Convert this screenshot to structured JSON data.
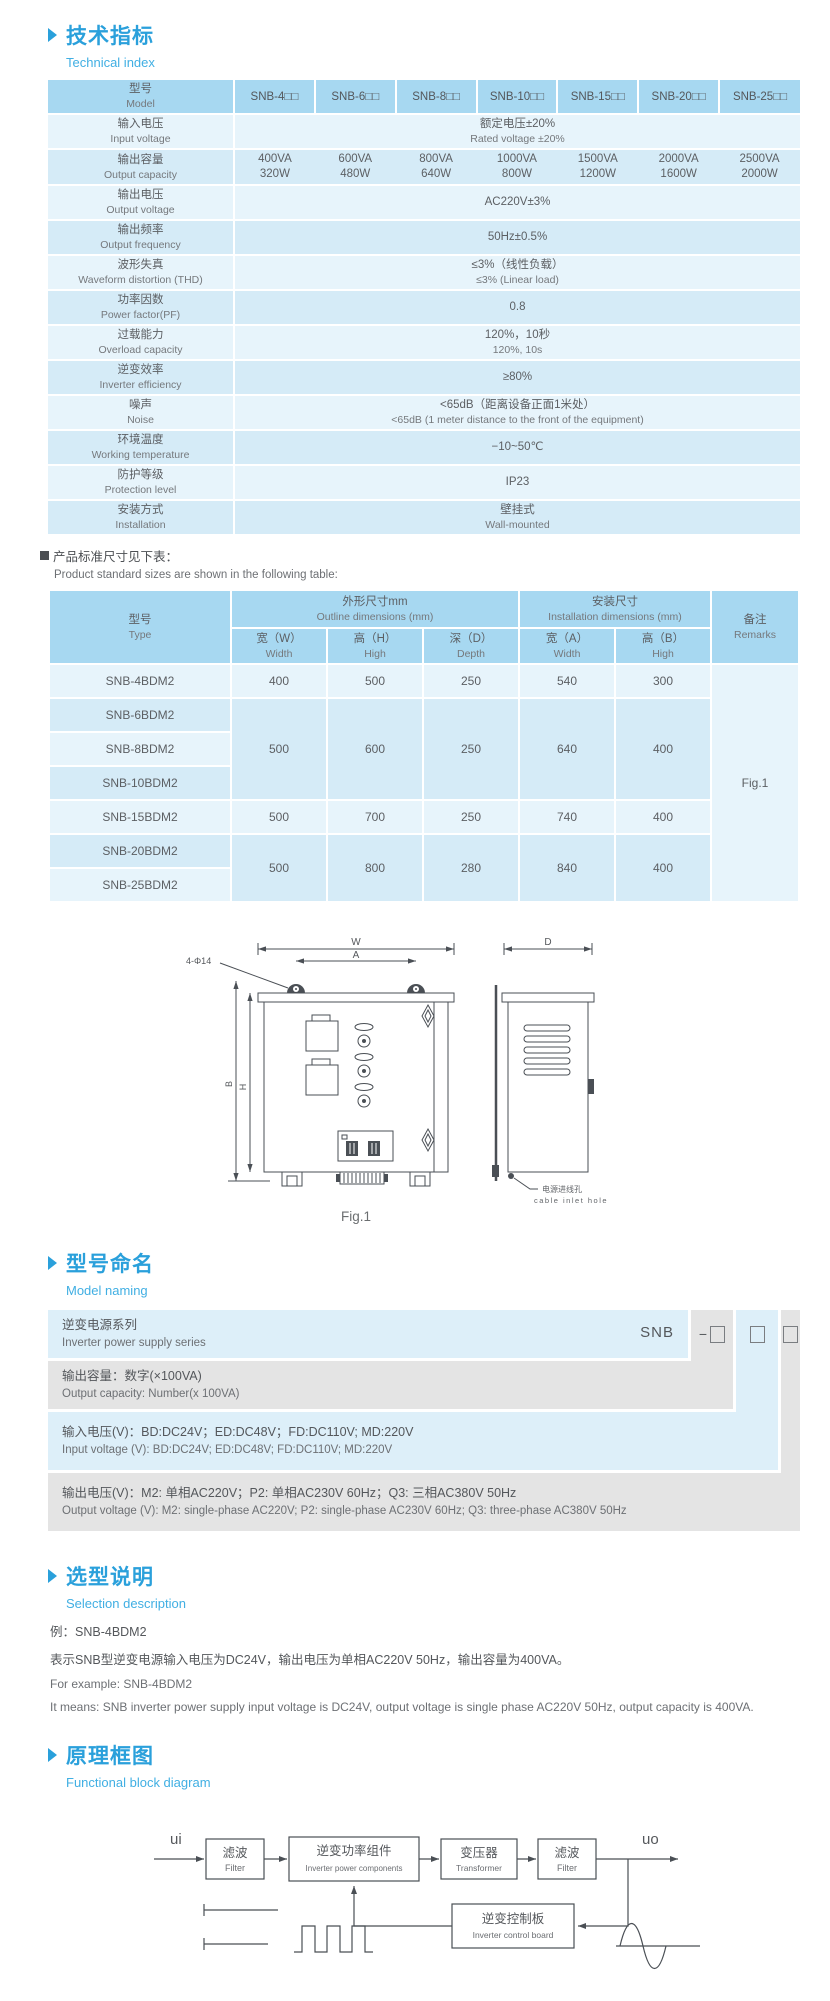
{
  "technical": {
    "title_cn": "技术指标",
    "title_en": "Technical index",
    "spec": {
      "header": {
        "label_cn": "型号",
        "label_en": "Model",
        "models": [
          "SNB-4□□",
          "SNB-6□□",
          "SNB-8□□",
          "SNB-10□□",
          "SNB-15□□",
          "SNB-20□□",
          "SNB-25□□"
        ]
      },
      "rows": [
        {
          "cn": "输入电压",
          "en": "Input voltage",
          "value_cn": "额定电压±20%",
          "value_en": "Rated voltage ±20%"
        },
        {
          "cn": "输出容量",
          "en": "Output capacity",
          "values": [
            {
              "va": "400VA",
              "w": "320W"
            },
            {
              "va": "600VA",
              "w": "480W"
            },
            {
              "va": "800VA",
              "w": "640W"
            },
            {
              "va": "1000VA",
              "w": "800W"
            },
            {
              "va": "1500VA",
              "w": "1200W"
            },
            {
              "va": "2000VA",
              "w": "1600W"
            },
            {
              "va": "2500VA",
              "w": "2000W"
            }
          ]
        },
        {
          "cn": "输出电压",
          "en": "Output voltage",
          "value_cn": "AC220V±3%",
          "value_en": ""
        },
        {
          "cn": "输出频率",
          "en": "Output frequency",
          "value_cn": "50Hz±0.5%",
          "value_en": ""
        },
        {
          "cn": "波形失真",
          "en": "Waveform distortion (THD)",
          "value_cn": "≤3%（线性负载）",
          "value_en": "≤3% (Linear load)"
        },
        {
          "cn": "功率因数",
          "en": "Power factor(PF)",
          "value_cn": "0.8",
          "value_en": ""
        },
        {
          "cn": "过载能力",
          "en": "Overload capacity",
          "value_cn": "120%，10秒",
          "value_en": "120%, 10s"
        },
        {
          "cn": "逆变效率",
          "en": "Inverter efficiency",
          "value_cn": "≥80%",
          "value_en": ""
        },
        {
          "cn": "噪声",
          "en": "Noise",
          "value_cn": "<65dB（距离设备正面1米处）",
          "value_en": "<65dB (1 meter distance to the front of the equipment)"
        },
        {
          "cn": "环境温度",
          "en": "Working temperature",
          "value_cn": "−10~50℃",
          "value_en": ""
        },
        {
          "cn": "防护等级",
          "en": "Protection level",
          "value_cn": "IP23",
          "value_en": ""
        },
        {
          "cn": "安装方式",
          "en": "Installation",
          "value_cn": "壁挂式",
          "value_en": "Wall-mounted"
        }
      ]
    },
    "note_cn": "产品标准尺寸见下表：",
    "note_en": "Product standard sizes are shown in the following table:",
    "dim": {
      "header": {
        "type_cn": "型号",
        "type_en": "Type",
        "outline_cn": "外形尺寸mm",
        "outline_en": "Outline dimensions  (mm)",
        "install_cn": "安装尺寸",
        "install_en": "Installation dimensions (mm)",
        "remarks_cn": "备注",
        "remarks_en": "Remarks",
        "w_cn": "宽（W）",
        "w_en": "Width",
        "h_cn": "高（H）",
        "h_en": "High",
        "d_cn": "深（D）",
        "d_en": "Depth",
        "a_cn": "宽（A）",
        "a_en": "Width",
        "b_cn": "高（B）",
        "b_en": "High"
      },
      "rows": [
        {
          "type": "SNB-4BDM2",
          "w": "400",
          "h": "500",
          "d": "250",
          "a": "540",
          "b": "300"
        },
        {
          "type": "SNB-6BDM2",
          "w": "500",
          "h": "600",
          "d": "250",
          "a": "640",
          "b": "400"
        },
        {
          "type": "SNB-8BDM2"
        },
        {
          "type": "SNB-10BDM2"
        },
        {
          "type": "SNB-15BDM2",
          "w": "500",
          "h": "700",
          "d": "250",
          "a": "740",
          "b": "400"
        },
        {
          "type": "SNB-20BDM2",
          "w": "500",
          "h": "800",
          "d": "280",
          "a": "840",
          "b": "400"
        },
        {
          "type": "SNB-25BDM2"
        }
      ],
      "remark": "Fig.1"
    }
  },
  "figure": {
    "dim_w": "W",
    "dim_a": "A",
    "dim_d": "D",
    "dim_h": "H",
    "dim_b": "B",
    "holes_label": "4-Φ14",
    "inlet_cn": "电源进线孔",
    "inlet_en": "cable inlet hole",
    "caption": "Fig.1"
  },
  "naming": {
    "title_cn": "型号命名",
    "title_en": "Model naming",
    "series": "SNB",
    "dash": "−",
    "rows": [
      {
        "cn": "逆变电源系列",
        "en": "Inverter power supply series"
      },
      {
        "cn": "输出容量：数字(×100VA)",
        "en": "Output capacity: Number(x 100VA)"
      },
      {
        "cn": "输入电压(V)：BD:DC24V；ED:DC48V；FD:DC110V; MD:220V",
        "en": "Input voltage (V): BD:DC24V;  ED:DC48V;  FD:DC110V; MD:220V"
      },
      {
        "cn": "输出电压(V)：M2: 单相AC220V；P2: 单相AC230V 60Hz；Q3: 三相AC380V 50Hz",
        "en": "Output voltage (V):  M2: single-phase AC220V;  P2: single-phase AC230V 60Hz;  Q3: three-phase AC380V 50Hz"
      }
    ]
  },
  "selection": {
    "title_cn": "选型说明",
    "title_en": "Selection description",
    "example_cn": "例：SNB-4BDM2",
    "desc_cn": "表示SNB型逆变电源输入电压为DC24V，输出电压为单相AC220V 50Hz，输出容量为400VA。",
    "example_en": "For example: SNB-4BDM2",
    "desc_en": "It means: SNB inverter power supply input voltage is DC24V, output voltage is single phase AC220V 50Hz, output capacity is 400VA."
  },
  "diagram": {
    "title_cn": "原理框图",
    "title_en": "Functional block diagram",
    "input_label": "ui",
    "output_label": "uo",
    "blocks": [
      {
        "cn": "滤波",
        "en": "Filter"
      },
      {
        "cn": "逆变功率组件",
        "en": "Inverter power components"
      },
      {
        "cn": "变压器",
        "en": "Transformer"
      },
      {
        "cn": "滤波",
        "en": "Filter"
      },
      {
        "cn": "逆变控制板",
        "en": "Inverter control board"
      }
    ]
  }
}
